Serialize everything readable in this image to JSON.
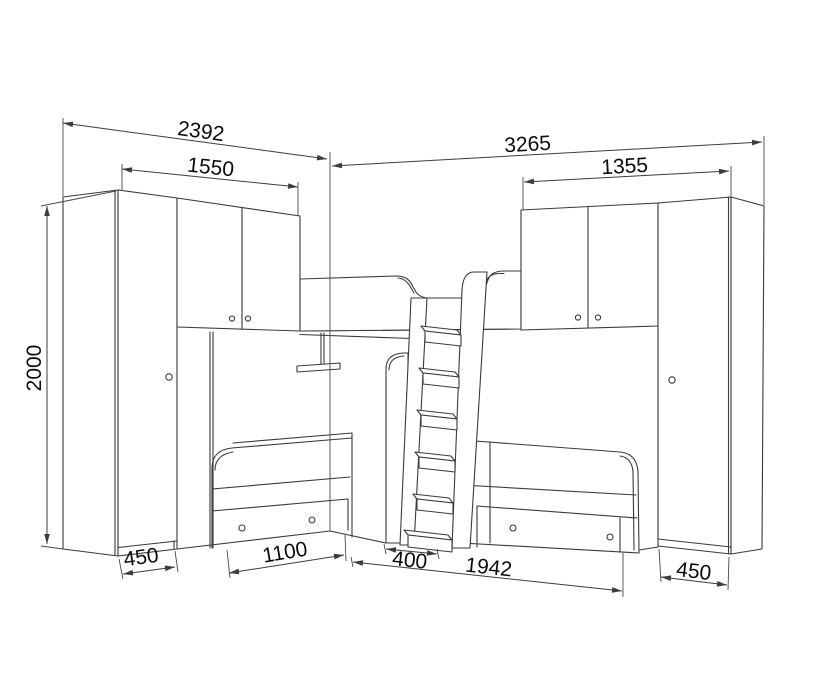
{
  "drawing": {
    "kind": "furniture-assembly-technical-drawing",
    "background_color": "#ffffff",
    "line_color": "#3a3a3a",
    "label_color": "#0b0b0b"
  },
  "dimension_labels": {
    "left_unit_total_width": "2392",
    "left_upper_section_width": "1550",
    "right_unit_total_width": "3265",
    "right_upper_section_width": "1355",
    "overall_height": "2000",
    "left_wardrobe_depth": "450",
    "left_bed_front_length": "1100",
    "ladder_base_width": "400",
    "right_bed_front_length": "1942",
    "right_wardrobe_depth": "450"
  }
}
